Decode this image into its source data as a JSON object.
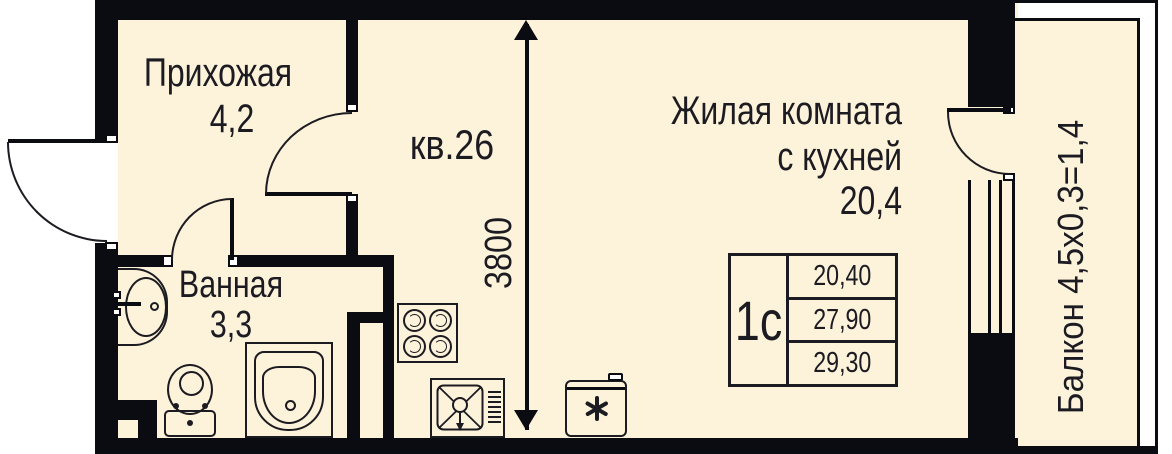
{
  "plan": {
    "apartment_label": "кв.26",
    "rooms": {
      "hallway": {
        "name": "Прихожая",
        "area": "4,2"
      },
      "bathroom": {
        "name": "Ванная",
        "area": "3,3"
      },
      "living": {
        "name_line1": "Жилая комната",
        "name_line2": "с кухней",
        "area": "20,4"
      },
      "balcony": {
        "label": "Балкон 4,5х0,3=1,4"
      }
    },
    "dimension_mm": "3800",
    "info_table": {
      "plan_type": "1с",
      "areas": [
        "20,40",
        "27,90",
        "29,30"
      ]
    },
    "colors": {
      "floor": "#fdf2da",
      "wall": "#0b0b12"
    }
  }
}
